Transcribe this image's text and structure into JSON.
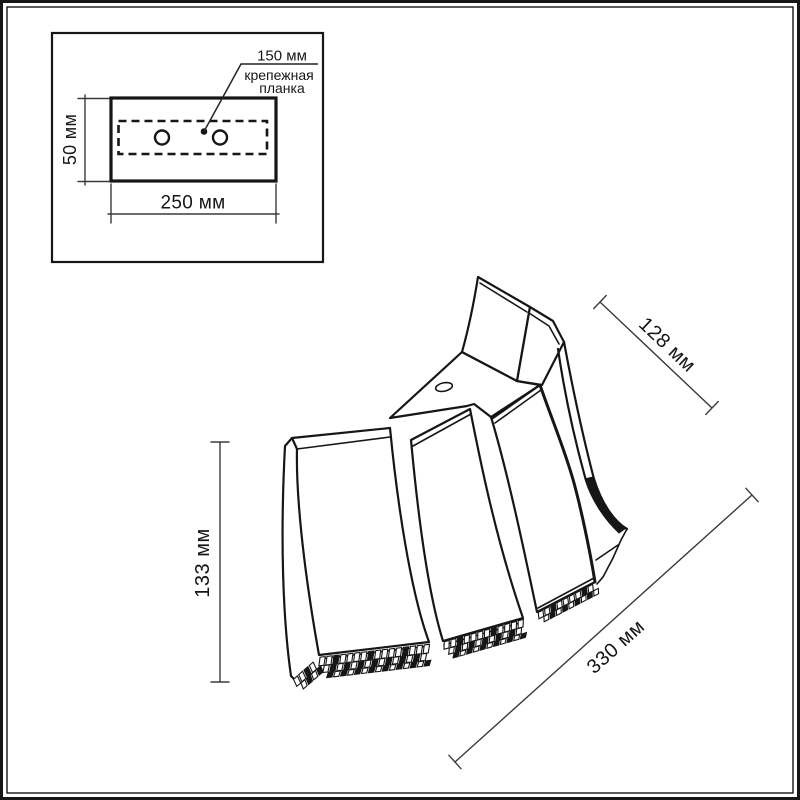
{
  "colors": {
    "line": "#161616",
    "dim_line": "#3a3a3a",
    "background": "#ffffff"
  },
  "inset": {
    "labels": {
      "hole_spacing": "150 мм",
      "bracket_name_line1": "крепежная",
      "bracket_name_line2": "планка",
      "plate_height": "50 мм",
      "plate_width": "250 мм"
    }
  },
  "main_view": {
    "dimensions": {
      "top_depth": "128 мм",
      "left_height": "133 мм",
      "diagonal_width": "330 мм"
    }
  }
}
